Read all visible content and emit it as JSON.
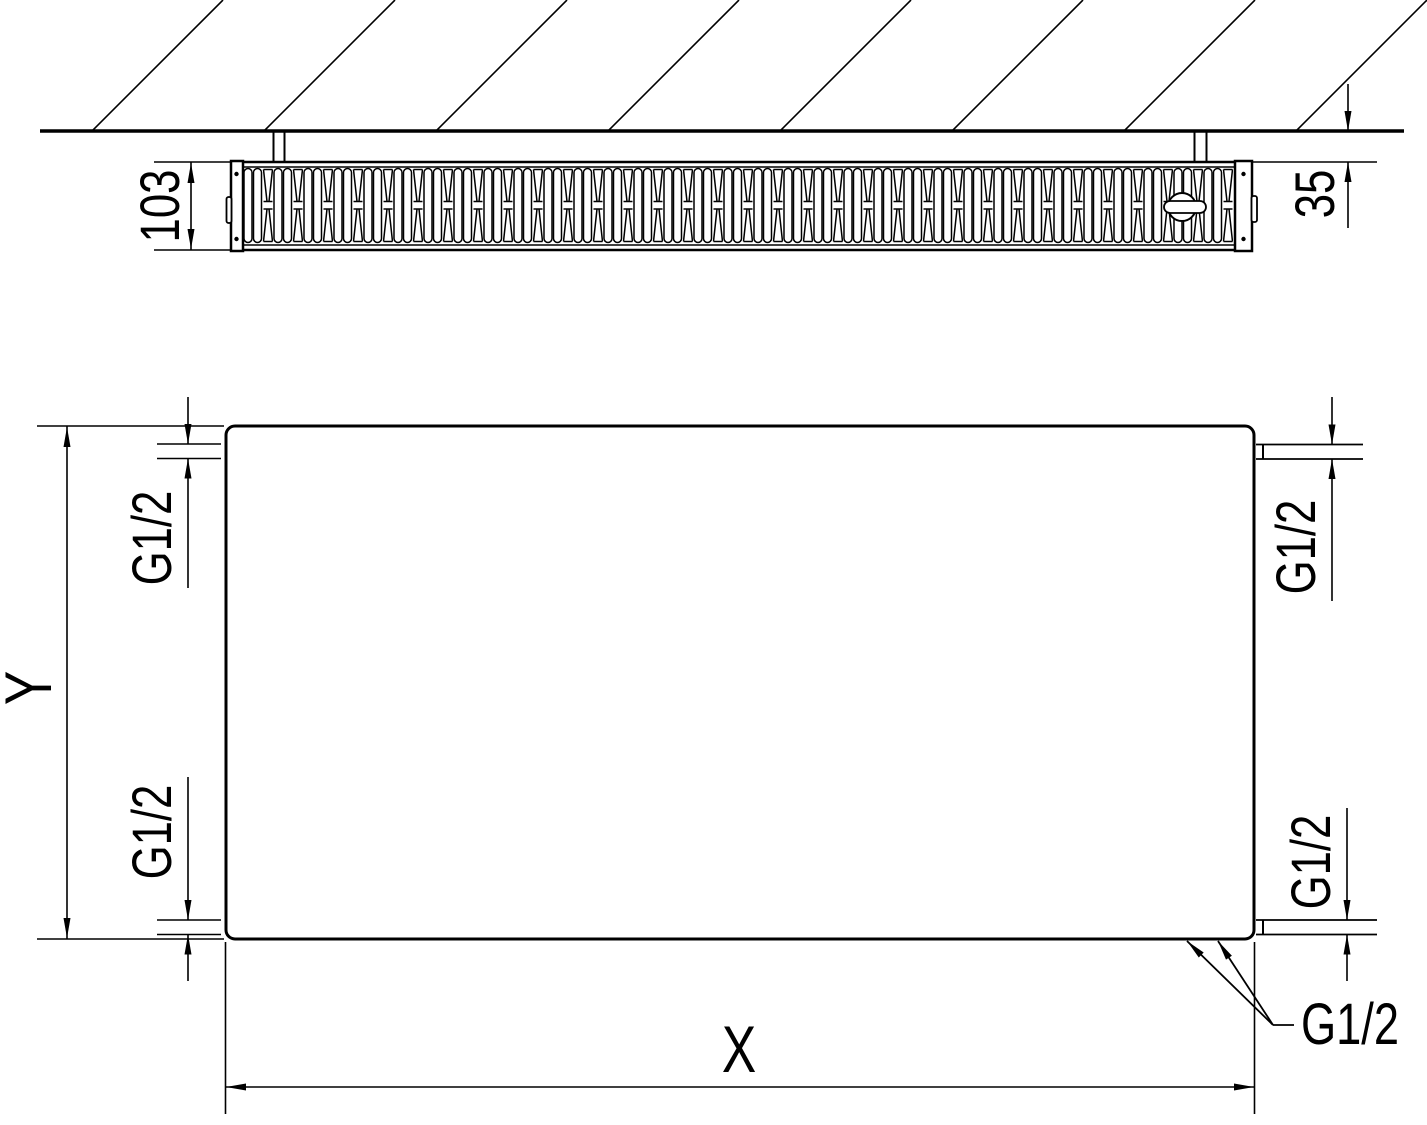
{
  "drawing": {
    "top_view": {
      "depth_label": "103",
      "wall_clearance_label": "35"
    },
    "front_view": {
      "width_label": "X",
      "height_label": "Y",
      "connection_top_left": "G1/2",
      "connection_top_right": "G1/2",
      "connection_bottom_left": "G1/2",
      "connection_bottom_right": "G1/2",
      "connection_callout": "G1/2"
    },
    "colors": {
      "line": "#000000",
      "background": "#ffffff"
    }
  }
}
